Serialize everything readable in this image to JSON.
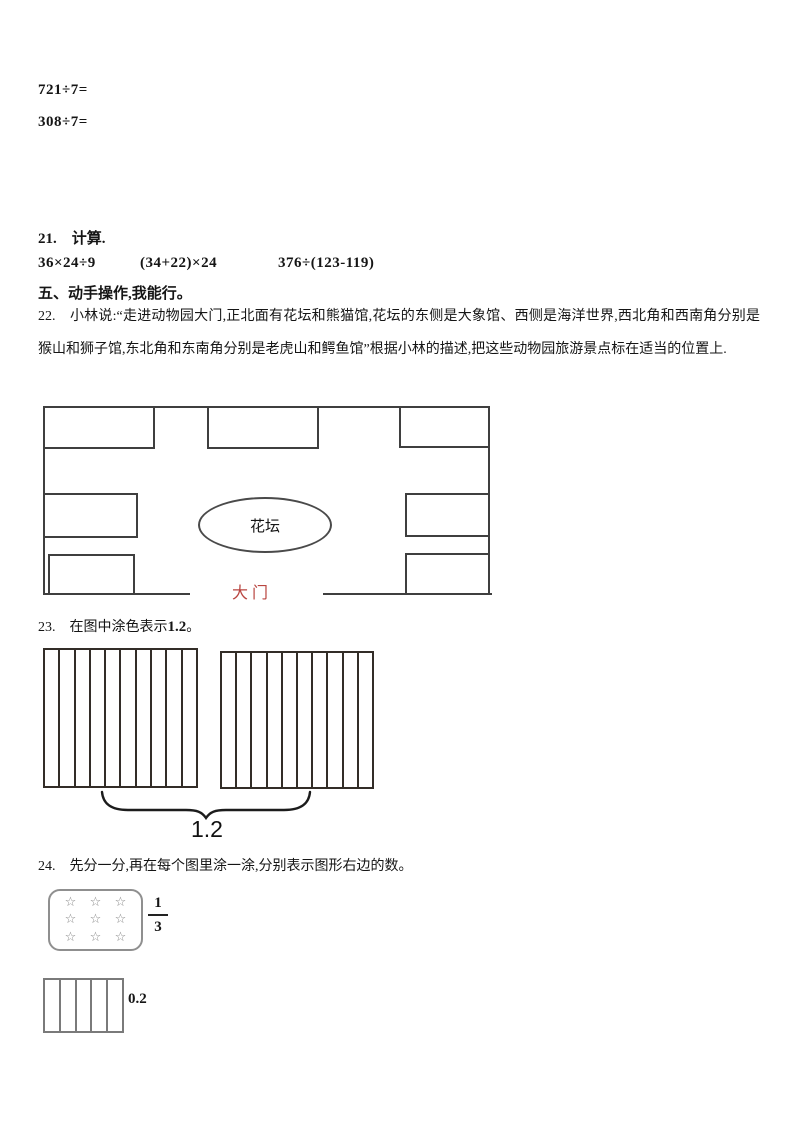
{
  "page": {
    "top_equations": {
      "eq1": "721÷7=",
      "eq2": "308÷7="
    },
    "q21": {
      "title": "21.　计算.",
      "expressions": [
        "36×24÷9",
        "(34+22)×24",
        "376÷(123-119)"
      ]
    },
    "section5_title": "五、动手操作,我能行。",
    "q22": {
      "text": "22.　小林说:“走进动物园大门,正北面有花坛和熊猫馆,花坛的东侧是大象馆、西侧是海洋世界,西北角和西南角分别是猴山和狮子馆,东北角和东南角分别是老虎山和鳄鱼馆”根据小林的描述,把这些动物园旅游景点标在适当的位置上.",
      "diagram": {
        "flowerbed_label": "花坛",
        "gate_label": "大门",
        "gate_color": "#b94540",
        "pavilion_count": 7
      }
    },
    "q23": {
      "title_prefix": "23.　在图中涂色表示",
      "title_value": "1.2",
      "title_suffix": "。",
      "strips_per_grid": 10,
      "grid_count": 2,
      "brace_label": "1.2"
    },
    "q24": {
      "title": "24.　先分一分,再在每个图里涂一涂,分别表示图形右边的数。",
      "star_box": {
        "rows": 3,
        "cols": 3,
        "star": "☆"
      },
      "fraction": {
        "numerator": "1",
        "denominator": "3"
      },
      "strip_rect": {
        "strips": 5,
        "label": "0.2"
      }
    }
  }
}
